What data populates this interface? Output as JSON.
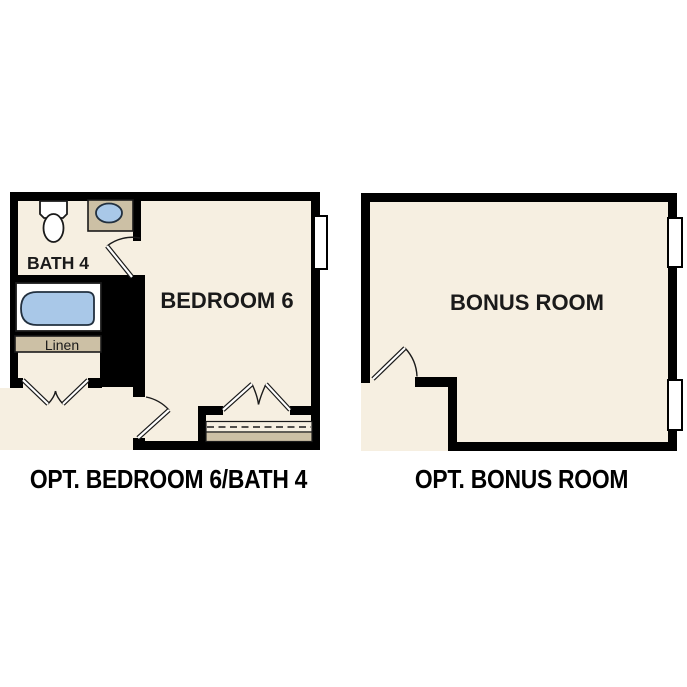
{
  "colors": {
    "background": "#ffffff",
    "wall": "#000000",
    "floor": "#f6efe1",
    "counter_tan": "#ccc0a5",
    "fixture_blue": "#a9c8e8",
    "line": "#1a1a1a"
  },
  "plans": {
    "left": {
      "caption": "OPT. BEDROOM 6/BATH 4",
      "bath_label": "BATH 4",
      "bedroom_label": "BEDROOM 6",
      "linen_label": "Linen",
      "fixtures": [
        "toilet",
        "sink-counter",
        "bathtub",
        "linen-shelf",
        "closet-rod-shelf",
        "window"
      ],
      "doors": [
        "bath-swing-door",
        "bedroom-swing-door",
        "linen-double-doors",
        "closet-double-doors"
      ]
    },
    "right": {
      "caption": "OPT. BONUS ROOM",
      "bonus_label": "BONUS ROOM",
      "fixtures": [
        "window-upper",
        "window-lower"
      ],
      "doors": [
        "entry-swing-door"
      ]
    }
  }
}
